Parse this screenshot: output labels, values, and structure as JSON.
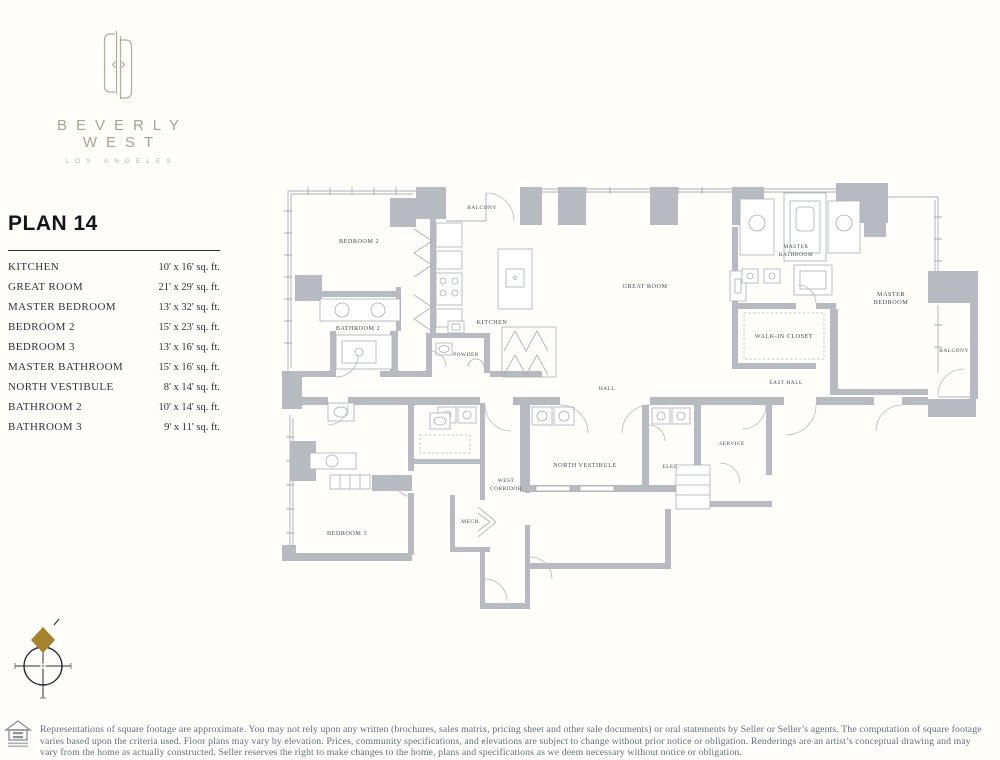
{
  "brand": {
    "name": "BEVERLY WEST",
    "city": "LOS ANGELES"
  },
  "plan": {
    "title": "PLAN 14"
  },
  "table": {
    "rows": [
      {
        "label": "KITCHEN",
        "value": "10' x 16' sq. ft."
      },
      {
        "label": "GREAT ROOM",
        "value": "21' x 29' sq. ft."
      },
      {
        "label": "MASTER BEDROOM",
        "value": "13' x 32' sq. ft."
      },
      {
        "label": "BEDROOM 2",
        "value": "15' x 23' sq. ft."
      },
      {
        "label": "BEDROOM 3",
        "value": "13' x 16' sq. ft."
      },
      {
        "label": "MASTER BATHROOM",
        "value": "15' x 16' sq. ft."
      },
      {
        "label": "NORTH VESTIBULE",
        "value": "8' x 14' sq. ft."
      },
      {
        "label": "BATHROOM 2",
        "value": "10' x 14' sq. ft."
      },
      {
        "label": "BATHROOM 3",
        "value": "9' x 11' sq. ft."
      }
    ]
  },
  "floorplan": {
    "labels": {
      "balcony_top": "BALCONY",
      "bedroom2": "BEDROOM 2",
      "bathroom2": "BATHROOM 2",
      "kitchen": "KITCHEN",
      "powder": "POWDER",
      "great_room": "GREAT ROOM",
      "master_bathroom": [
        "MASTER",
        "BATHROOM"
      ],
      "walk_in_closet": "WALK-IN CLOSET",
      "master_bedroom": [
        "MASTER",
        "BEDROOM"
      ],
      "balcony_right": "BALCONY",
      "east_hall": "EAST HALL",
      "hall": "HALL",
      "north_vestibule": "NORTH VESTIBULE",
      "elec": "ELEC.",
      "service": "SERVICE",
      "west_corridor": [
        "WEST",
        "CORRIDOR"
      ],
      "mech": "MECH.",
      "bedroom3": "BEDROOM 3"
    }
  },
  "footer": {
    "disclaimer": "Representations of square footage are approximate. You may not rely upon any written (brochures, sales matrix, pricing sheet and other sale documents) or oral statements by Seller or Seller’s agents. The computation of square footage varies based upon the criteria used. Floor plans may vary by elevation. Prices, community specifications, and elevations are subject to change without prior notice or obligation. Renderings are an artist’s conceptual drawing and may vary from the home as actually constructed. Seller reserves the right to make changes to the home, plans and specifications as we deem necessary without notice or obligation."
  },
  "colors": {
    "wall_gray": "#b7bbc1",
    "line_gray": "#a9aeb6",
    "label_ink": "#474d57",
    "logo_taupe": "#a9a196",
    "accent_gold": "#a4822e",
    "disclaimer_ink": "#5f7183",
    "heading_ink": "#141518"
  }
}
